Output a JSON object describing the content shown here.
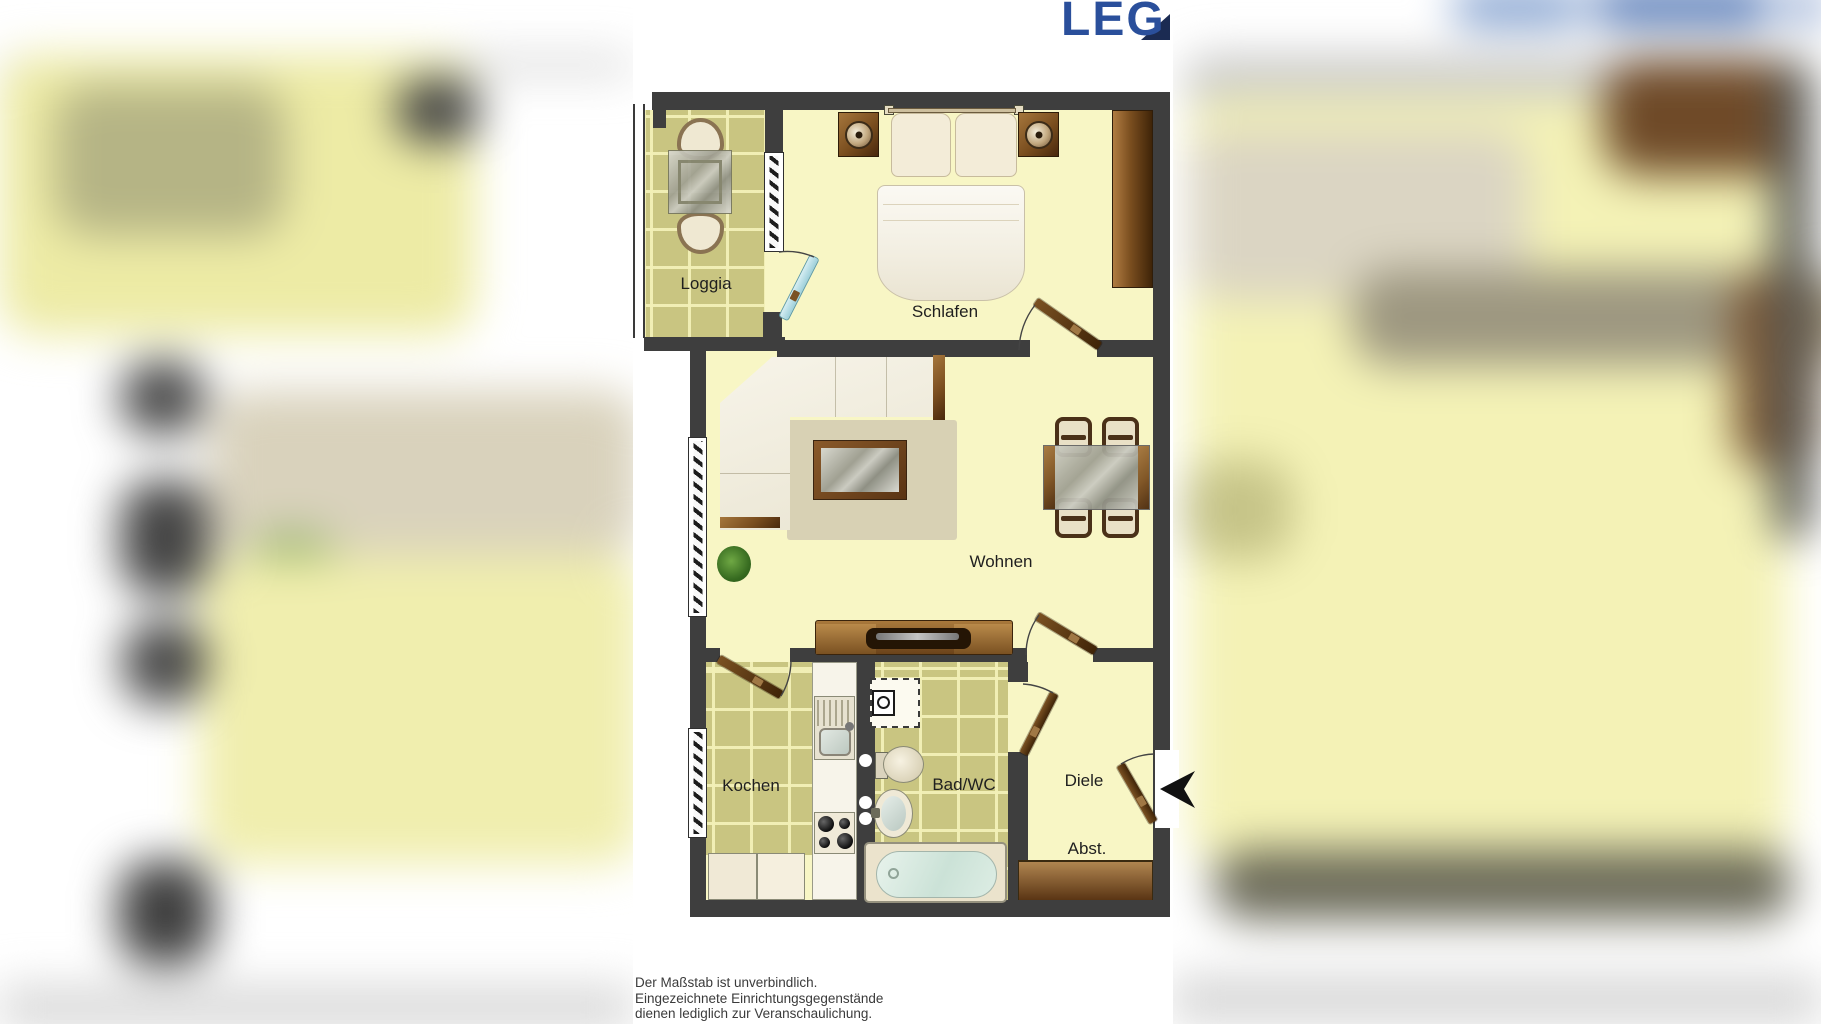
{
  "brand": {
    "logo_text": "LEG"
  },
  "floorplan": {
    "rooms": {
      "loggia": "Loggia",
      "schlafen": "Schlafen",
      "wohnen": "Wohnen",
      "kochen": "Kochen",
      "bad": "Bad/WC",
      "diele": "Diele",
      "abstellraum": "Abst."
    },
    "furniture": [
      "bed",
      "nightstands",
      "wardrobe",
      "corner-sofa",
      "coffee-table",
      "rug",
      "plant",
      "dining-table",
      "dining-chairs",
      "tv-sideboard",
      "balcony-table",
      "balcony-chairs",
      "kitchen-counter",
      "sink",
      "stove",
      "cabinets",
      "washing-machine",
      "toilet",
      "washbasin",
      "bathtub",
      "storage-shelf"
    ]
  },
  "disclaimer": {
    "line1": "Der Maßstab ist unverbindlich.",
    "line2": "Eingezeichnete Einrichtungsgegenstände",
    "line3": "dienen lediglich zur Veranschaulichung."
  },
  "colors": {
    "logo_blue": "#2A4F9B",
    "logo_navy": "#1B2B52",
    "wall": "#3E3E3E",
    "floor_yellow": "#F8F6C5",
    "tile_olive": "#C9C581",
    "wood_brown": "#6B4520",
    "water_blue": "#D5E8DE"
  }
}
